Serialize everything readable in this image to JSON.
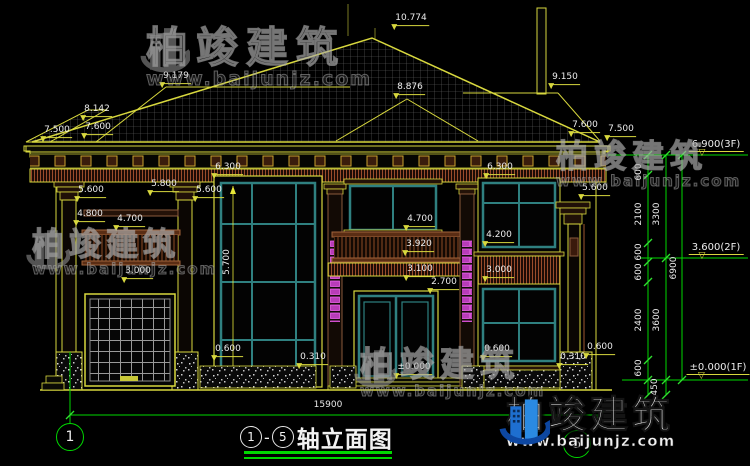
{
  "drawing": {
    "title": {
      "axis_start": "1",
      "axis_sep": "-",
      "axis_end": "5",
      "name": "轴立面图"
    },
    "overall_width": "15900",
    "grid_bubbles": [
      "1",
      "5"
    ],
    "colors": {
      "line_yellow": "#d8d83e",
      "axis_green": "#00d800",
      "window_teal": "#2f8080",
      "decor_magenta": "#c040c0",
      "text_white": "#ececec"
    },
    "level_markers": [
      "6.900(3F)",
      "3.600(2F)",
      "±0.000(1F)"
    ]
  },
  "watermark": {
    "brand": "柏竣建筑",
    "url": "www.baijunjz.com"
  },
  "dim_labels": [
    {
      "t": "10.774",
      "x": 411,
      "y": 26,
      "k": "u"
    },
    {
      "t": "9.179",
      "x": 176,
      "y": 84,
      "k": "u"
    },
    {
      "t": "9.150",
      "x": 565,
      "y": 85,
      "k": "u"
    },
    {
      "t": "8.876",
      "x": 410,
      "y": 95,
      "k": "u"
    },
    {
      "t": "8.142",
      "x": 97,
      "y": 117,
      "k": "u"
    },
    {
      "t": "7.600",
      "x": 98,
      "y": 135,
      "k": "u"
    },
    {
      "t": "7.500",
      "x": 57,
      "y": 138,
      "k": "u"
    },
    {
      "t": "7.600",
      "x": 585,
      "y": 133,
      "k": "u"
    },
    {
      "t": "7.500",
      "x": 621,
      "y": 137,
      "k": "u"
    },
    {
      "t": "6.300",
      "x": 228,
      "y": 175,
      "k": "u"
    },
    {
      "t": "6.300",
      "x": 500,
      "y": 175,
      "k": "u"
    },
    {
      "t": "5.600",
      "x": 91,
      "y": 198,
      "k": "u"
    },
    {
      "t": "5.800",
      "x": 164,
      "y": 192,
      "k": "u"
    },
    {
      "t": "5.600",
      "x": 209,
      "y": 198,
      "k": "u"
    },
    {
      "t": "5.600",
      "x": 595,
      "y": 196,
      "k": "u"
    },
    {
      "t": "4.800",
      "x": 90,
      "y": 222,
      "k": "u"
    },
    {
      "t": "4.700",
      "x": 130,
      "y": 227,
      "k": "u"
    },
    {
      "t": "4.700",
      "x": 420,
      "y": 227,
      "k": "u"
    },
    {
      "t": "3.920",
      "x": 419,
      "y": 252,
      "k": "u"
    },
    {
      "t": "3.100",
      "x": 420,
      "y": 277,
      "k": "u"
    },
    {
      "t": "2.700",
      "x": 444,
      "y": 290,
      "k": "u"
    },
    {
      "t": "4.200",
      "x": 499,
      "y": 243,
      "k": "u"
    },
    {
      "t": "3.000",
      "x": 499,
      "y": 278,
      "k": "u"
    },
    {
      "t": "3.000",
      "x": 138,
      "y": 279,
      "k": "u"
    },
    {
      "t": "0.600",
      "x": 228,
      "y": 357,
      "k": "u"
    },
    {
      "t": "0.310",
      "x": 313,
      "y": 365,
      "k": "u"
    },
    {
      "t": "0.600",
      "x": 497,
      "y": 357,
      "k": "u"
    },
    {
      "t": "0.310",
      "x": 573,
      "y": 365,
      "k": "u"
    },
    {
      "t": "0.600",
      "x": 600,
      "y": 355,
      "k": "u"
    },
    {
      "t": "±0.000",
      "x": 414,
      "y": 375,
      "k": "u"
    },
    {
      "t": "5.700",
      "x": 228,
      "y": 262,
      "k": "r"
    },
    {
      "t": "600",
      "x": 640,
      "y": 172,
      "k": "r"
    },
    {
      "t": "2100",
      "x": 640,
      "y": 214,
      "k": "r"
    },
    {
      "t": "3300",
      "x": 658,
      "y": 214,
      "k": "r"
    },
    {
      "t": "600",
      "x": 640,
      "y": 252,
      "k": "r"
    },
    {
      "t": "600",
      "x": 640,
      "y": 272,
      "k": "r"
    },
    {
      "t": "2400",
      "x": 640,
      "y": 320,
      "k": "r"
    },
    {
      "t": "3600",
      "x": 658,
      "y": 320,
      "k": "r"
    },
    {
      "t": "6900",
      "x": 675,
      "y": 268,
      "k": "r"
    },
    {
      "t": "600",
      "x": 640,
      "y": 368,
      "k": "r"
    },
    {
      "t": "450",
      "x": 656,
      "y": 387,
      "k": "r"
    },
    {
      "t": "6.900(3F)",
      "x": 716,
      "y": 152,
      "k": "lvl"
    },
    {
      "t": "3.600(2F)",
      "x": 716,
      "y": 255,
      "k": "lvl"
    },
    {
      "t": "±0.000(1F)",
      "x": 718,
      "y": 375,
      "k": "lvl"
    },
    {
      "t": "15900",
      "x": 328,
      "y": 411,
      "k": "p"
    }
  ]
}
